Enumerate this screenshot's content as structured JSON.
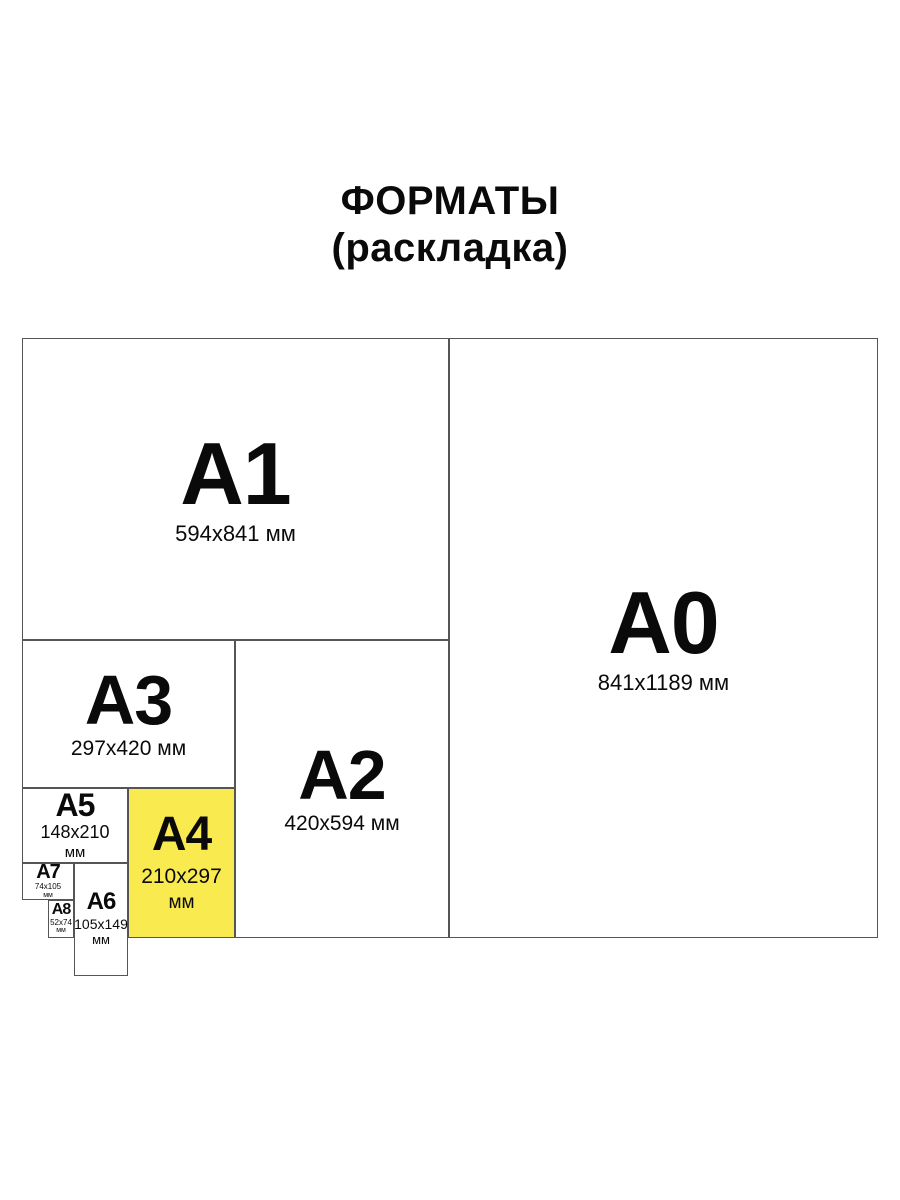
{
  "title": {
    "line1": "ФОРМАТЫ",
    "line2": "(раскладка)"
  },
  "colors": {
    "highlight_fill": "#F9EA50",
    "border": "#555555",
    "text": "#0A0A0A",
    "background": "#FFFFFF"
  },
  "formats": {
    "a0": {
      "label": "A0",
      "size": "841x1189 мм"
    },
    "a1": {
      "label": "A1",
      "size": "594x841 мм"
    },
    "a2": {
      "label": "A2",
      "size": "420x594 мм"
    },
    "a3": {
      "label": "A3",
      "size": "297x420 мм"
    },
    "a4": {
      "label": "A4",
      "size": "210x297",
      "unit": "мм"
    },
    "a5": {
      "label": "A5",
      "size": "148x210",
      "unit": "мм"
    },
    "a6": {
      "label": "A6",
      "size": "105x149",
      "unit": "мм"
    },
    "a7": {
      "label": "A7",
      "size": "74x105",
      "unit": "мм"
    },
    "a8": {
      "label": "A8",
      "size": "52x74",
      "unit": "мм"
    }
  }
}
